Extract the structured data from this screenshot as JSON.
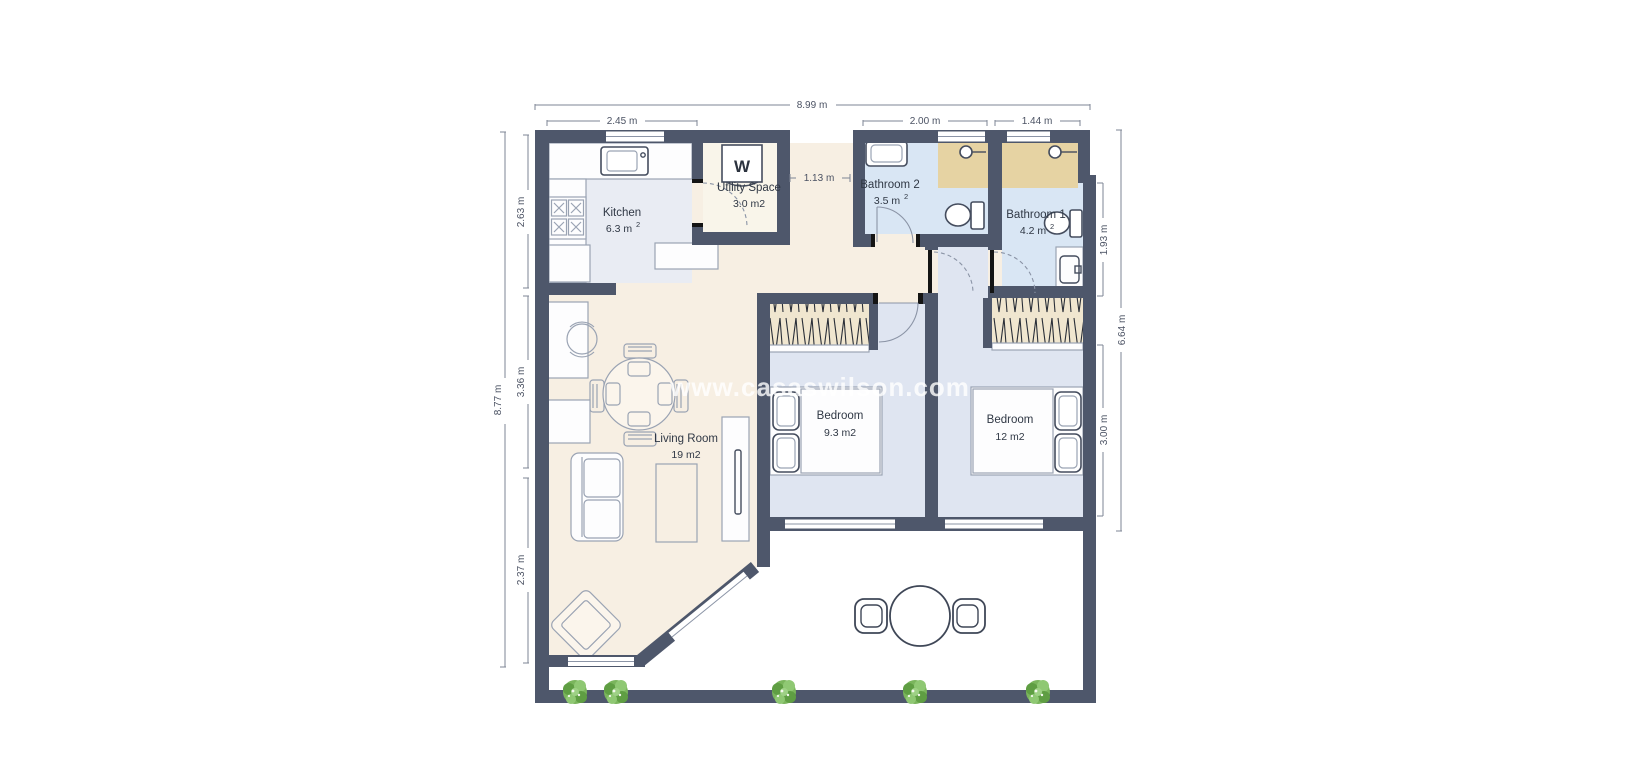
{
  "watermark": "www.casaswilson.com",
  "rooms": {
    "kitchen": {
      "name": "Kitchen",
      "area": "6.3 m",
      "area_sup": "2"
    },
    "utility": {
      "name": "Utility Space",
      "area": "3.0 m2"
    },
    "bathroom2": {
      "name": "Bathroom 2",
      "area": "3.5 m",
      "area_sup": "2"
    },
    "bathroom1": {
      "name": "Bathroom 1",
      "area": "4.2 m",
      "area_sup": "2"
    },
    "living_room": {
      "name": "Living Room",
      "area": "19 m2"
    },
    "bedroom_1": {
      "name": "Bedroom",
      "area": "9.3 m2"
    },
    "bedroom_2": {
      "name": "Bedroom",
      "area": "12 m2"
    }
  },
  "appliances": {
    "washing_machine": "W"
  },
  "dimensions": {
    "total_width": "8.99 m",
    "kitchen_width": "2.45 m",
    "bathroom2_width": "2.00 m",
    "bathroom1_width": "1.44 m",
    "hall_width": "1.13 m",
    "total_height_left": "8.77 m",
    "kitchen_height": "2.63 m",
    "living_mid_height": "3.36 m",
    "living_bottom_height": "2.37 m",
    "bathroom1_height": "1.93 m",
    "right_total_height": "6.64 m",
    "bedroom_height": "3.00 m"
  },
  "colors": {
    "walls": "#4e576b",
    "living_floor": "#f7efe3",
    "kitchen_floor": "#e9ecf3",
    "bathroom_floor": "#d9e6f4",
    "bedroom_floor": "#dfe5f1",
    "utility_floor": "#f9f5ea",
    "shower_area": "#e6d3a3",
    "wardrobe": "#f0e6cf",
    "tree_green": "#6fae4e",
    "watermark_white": "#ffffff"
  }
}
